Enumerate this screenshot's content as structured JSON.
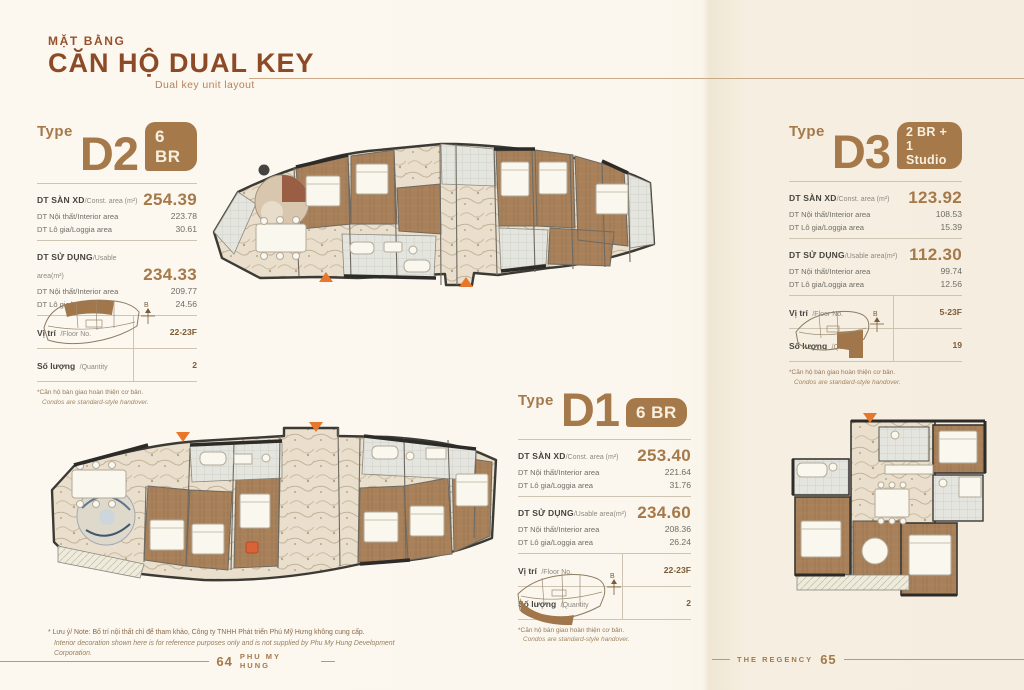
{
  "header": {
    "kicker": "MẶT BẰNG",
    "title": "CĂN HỘ DUAL KEY",
    "subtitle": "Dual key unit layout"
  },
  "labels": {
    "type": "Type",
    "san_xd": "DT SÀN XD",
    "const_area": "/Const. area (m²)",
    "noi_that": "DT Nội thất",
    "interior": "/Interior area",
    "lo_gia": "DT Lô gia",
    "loggia": "/Loggia area",
    "su_dung": "DT SỬ DỤNG",
    "usable": "/Usable area(m²)",
    "vi_tri": "Vị trí",
    "floor_no": "/Floor No.",
    "so_luong": "Số lượng",
    "quantity": "/Quantity"
  },
  "units": [
    {
      "name": "D2",
      "badge1": "6 BR",
      "badge2": "",
      "g1": {
        "val": "254.39",
        "r1": "223.78",
        "r2": "30.61"
      },
      "g2": {
        "val": "234.33",
        "r1": "209.77",
        "r2": "24.56"
      },
      "loc": "22-23F",
      "qty": "2"
    },
    {
      "name": "D1",
      "badge1": "6 BR",
      "badge2": "",
      "g1": {
        "val": "253.40",
        "r1": "221.64",
        "r2": "31.76"
      },
      "g2": {
        "val": "234.60",
        "r1": "208.36",
        "r2": "26.24"
      },
      "loc": "22-23F",
      "qty": "2"
    },
    {
      "name": "D3",
      "badge1": "2 BR +",
      "badge2": "1 Studio",
      "g1": {
        "val": "123.92",
        "r1": "108.53",
        "r2": "15.39"
      },
      "g2": {
        "val": "112.30",
        "r1": "99.74",
        "r2": "12.56"
      },
      "loc": "5-23F",
      "qty": "19"
    }
  ],
  "footnote": {
    "vi": "*Căn hộ bàn giao hoàn thiện cơ bản.",
    "en": "Condos are standard-style handover."
  },
  "note": {
    "vi": "* Lưu ý/ Note: Bố trí nội thất chỉ để tham khảo, Công ty TNHH Phát triển Phú Mỹ Hưng không cung cấp.",
    "en": "Interior decoration shown here is for reference purposes only and is not supplied by Phu My Hung Development Corporation."
  },
  "footer": {
    "left_page": "64",
    "left_label": "PHU MY HUNG",
    "right_label": "THE REGENCY",
    "right_page": "65"
  },
  "compass": {
    "label": "B"
  },
  "colors": {
    "accent_brown": "#a5794a",
    "title_rust": "#8c4a26",
    "entry_orange": "#e8762b",
    "wall_dark": "#3c3a35",
    "wood": "#a8815a",
    "marble": "#e9dfcc"
  }
}
